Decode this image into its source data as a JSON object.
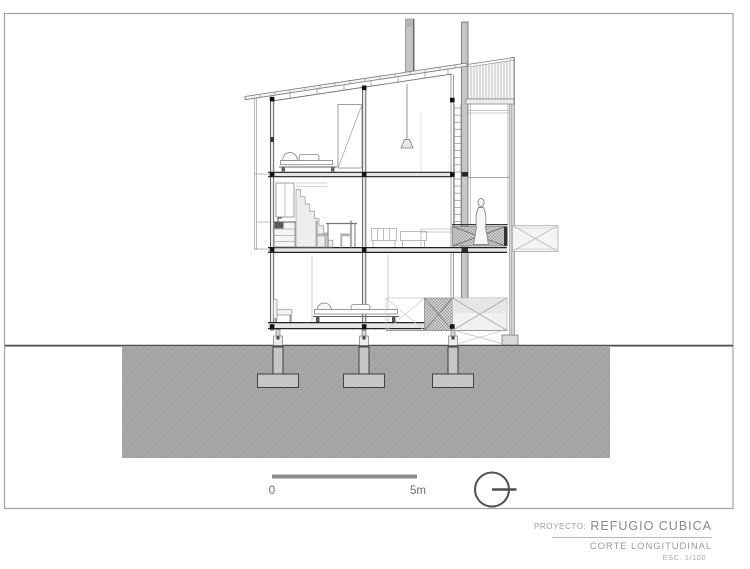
{
  "sheet": {
    "background": "#ffffff",
    "frame_color": "#a3a3a3",
    "line_color": "#787878",
    "section_cut_color": "#1f1f1f",
    "soil_color": "#a7a7a7",
    "concrete_color": "#c6c6c6",
    "title_text_color": "#8f8f8f"
  },
  "drawing": {
    "type": "architectural-longitudinal-section",
    "elements": "sloped shed roof, chimney, louver screen, three levels, bedrooms, kitchen with stair and dining, mid-level bridge with human figure, lower walkway, three pile foundations in ground"
  },
  "scale_bar": {
    "start_label": "0",
    "end_label": "5m"
  },
  "symbols": {
    "orientation_icon": "circle-with-horizontal-tick"
  },
  "title_block": {
    "project_label": "PROYECTO:",
    "project_name": "REFUGIO CUBICA",
    "drawing_title": "CORTE LONGITUDINAL",
    "scale_label": "ESC. 1/100"
  }
}
